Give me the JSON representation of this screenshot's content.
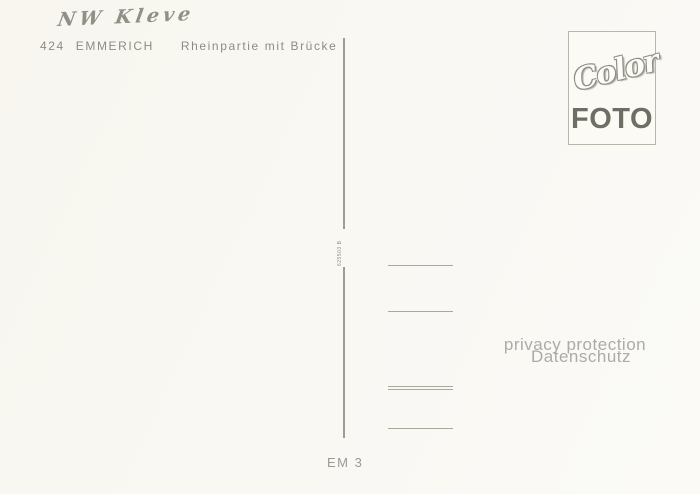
{
  "postcard": {
    "handwritten_note": "NW Kleve",
    "title": {
      "number": "424",
      "city": "EMMERICH",
      "caption": "Rheinpartie mit Brücke"
    },
    "logo": {
      "script_word": "Color",
      "block_word": "FOTO"
    },
    "print_code": "625503 B",
    "watermark": {
      "line1": "privacy protection",
      "line2": "Datenschutz"
    },
    "series_code": "EM 3",
    "colors": {
      "background": "#f8f6ef",
      "printed_text": "#8c8d82",
      "pencil": "#8f9186",
      "divider": "#9c9c92",
      "address_line": "#a9a899",
      "watermark": "#ababab",
      "logo_foto": "#6e6e65",
      "logo_border": "#b7b6ab"
    }
  }
}
